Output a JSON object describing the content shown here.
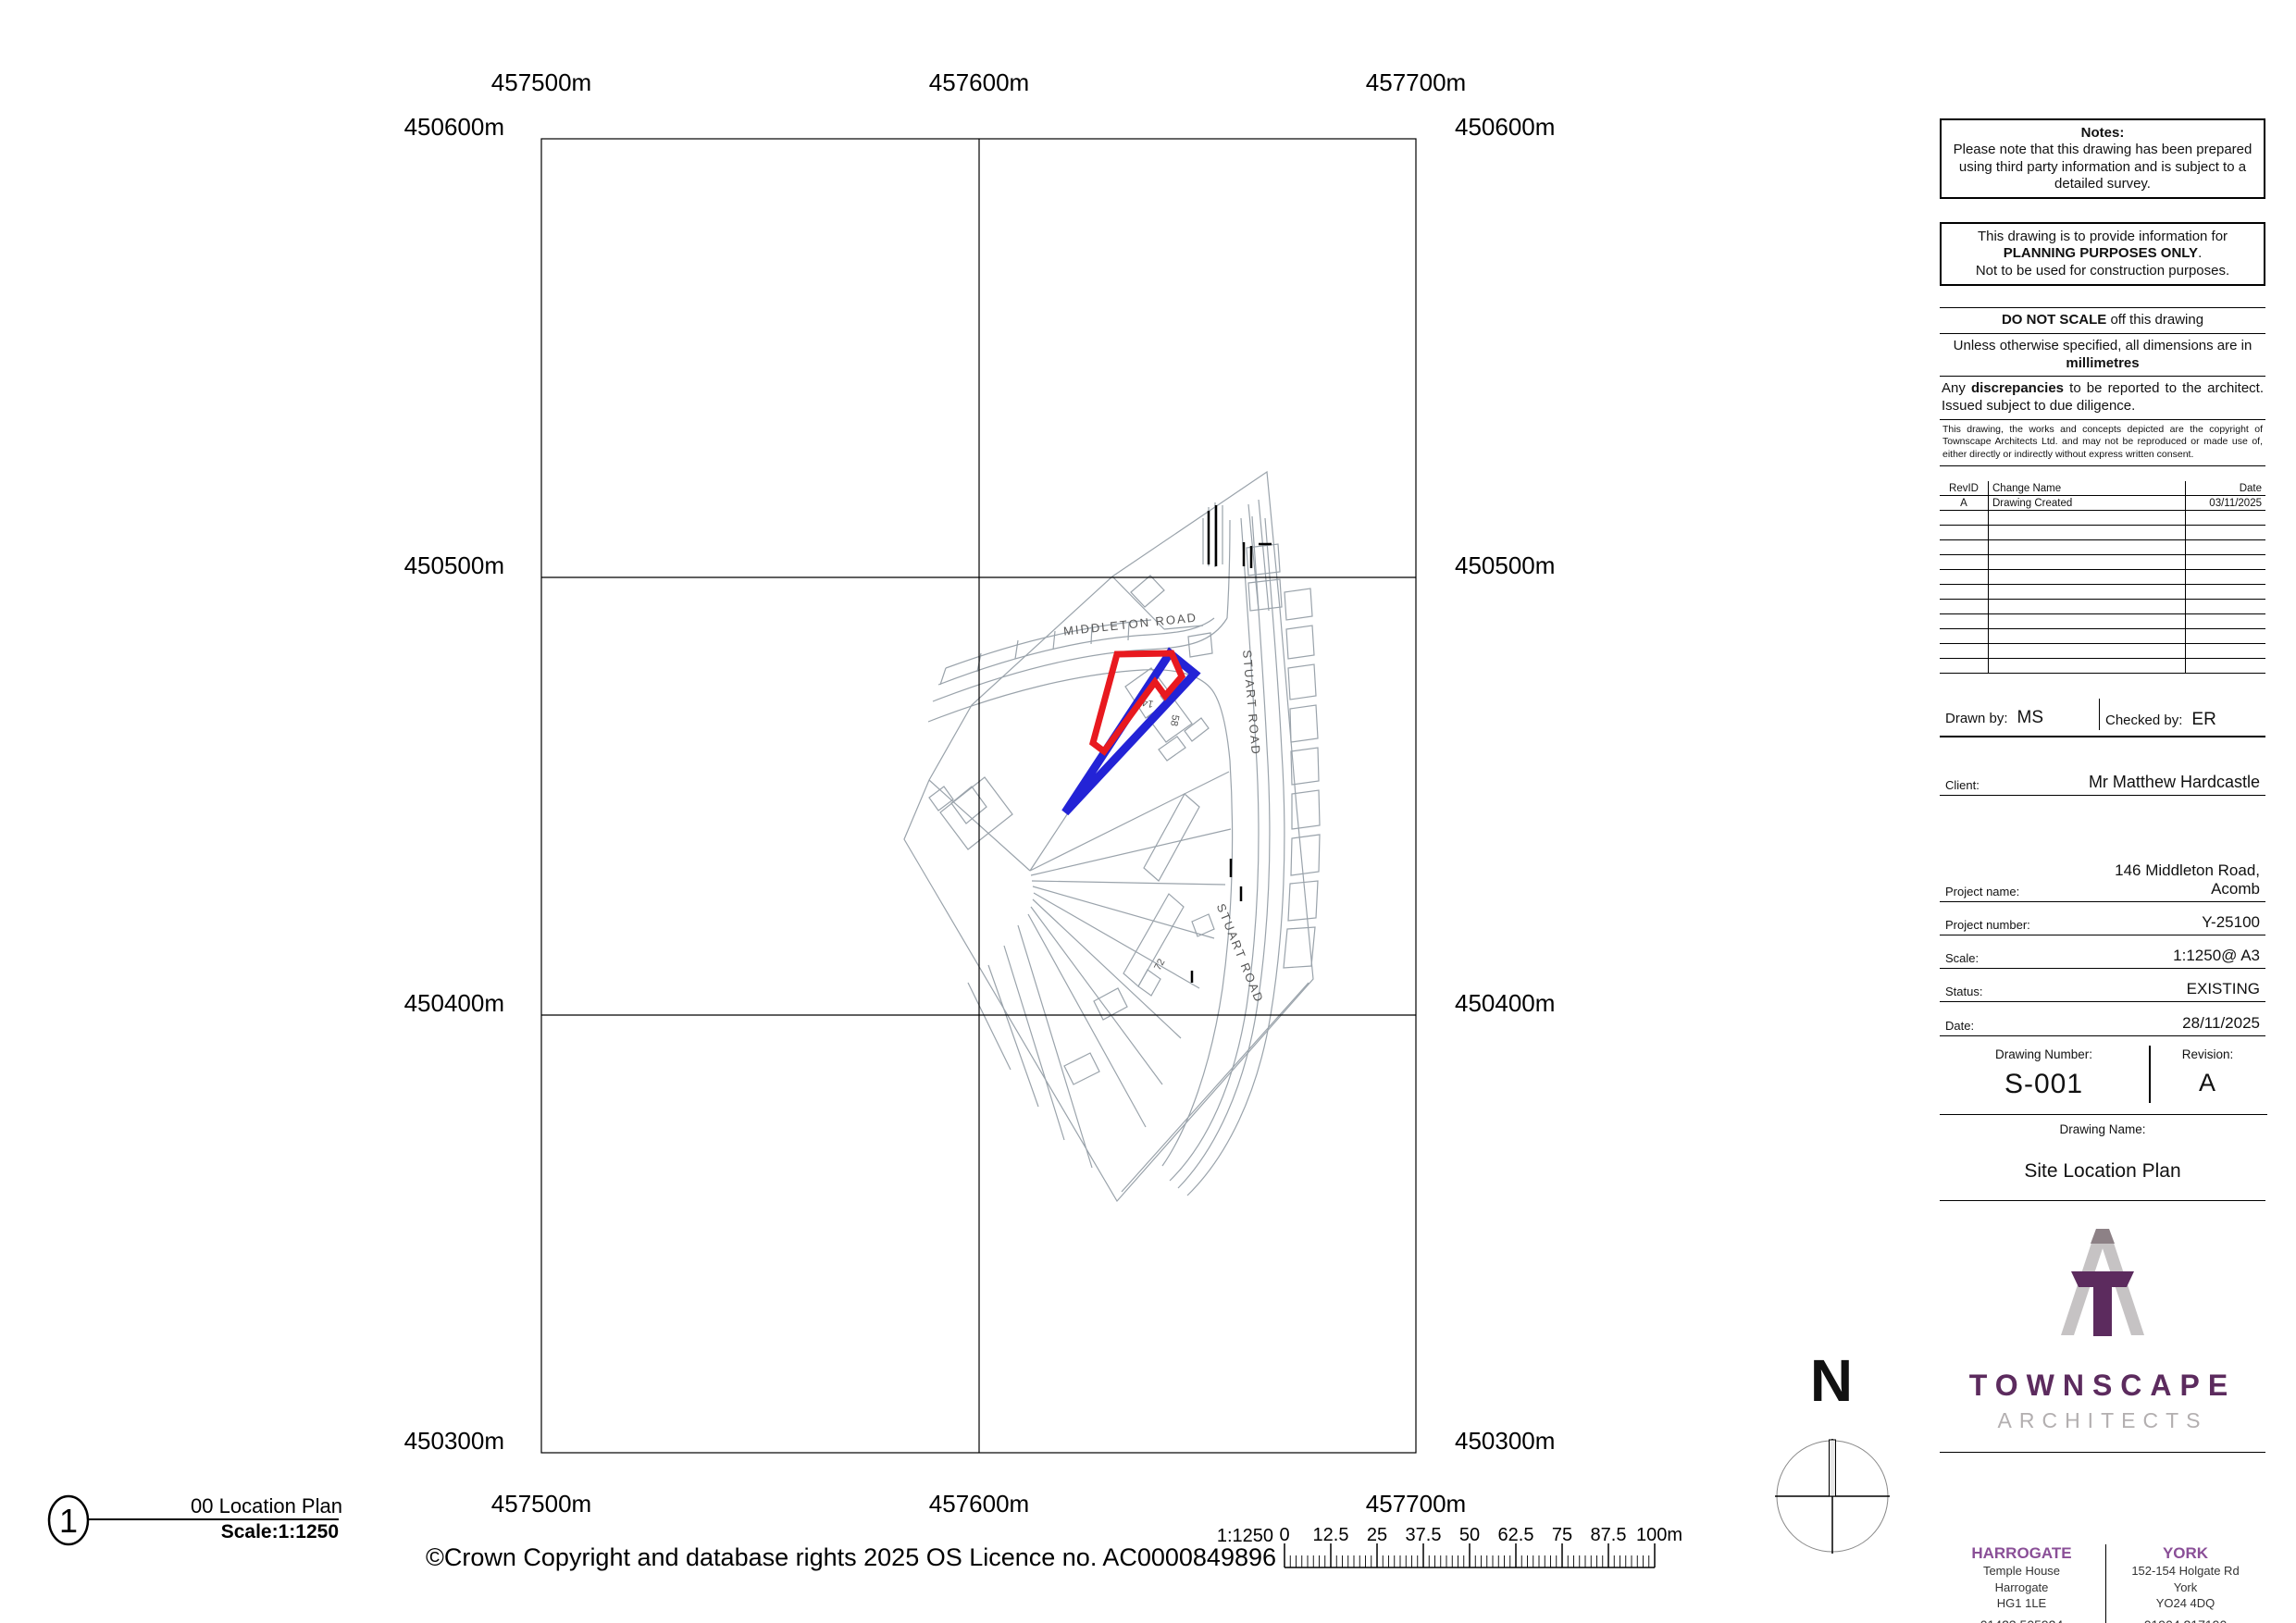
{
  "grid": {
    "eastings": [
      "457500m",
      "457600m",
      "457700m"
    ],
    "northings": [
      "450600m",
      "450500m",
      "450400m",
      "450300m"
    ]
  },
  "map": {
    "road_label_middleton": "MIDDLETON ROAD",
    "road_label_stuart_upper": "STUART ROAD",
    "road_label_stuart_lower": "STUART ROAD",
    "house_146": "146",
    "house_58": "58",
    "house_72": "72",
    "site_boundary_color": "#e8191f",
    "highlight_color": "#2323d6"
  },
  "viewport": {
    "number": "1",
    "title": "00 Location Plan",
    "scale_label": "Scale:1:1250"
  },
  "copyright": "©Crown Copyright and database rights 2025 OS Licence no. AC0000849896",
  "scale_bar": {
    "ratio": "1:1250",
    "tick_labels": [
      "0",
      "12.5",
      "25",
      "37.5",
      "50",
      "62.5",
      "75",
      "87.5",
      "100m"
    ]
  },
  "compass": {
    "north_label": "N"
  },
  "titleblock": {
    "notes": {
      "title": "Notes:",
      "body": "Please note that this drawing has been prepared using third party information and is subject to a detailed survey."
    },
    "planning": {
      "line1": "This drawing is to provide information for",
      "line2": "PLANNING PURPOSES ONLY",
      "line2_suffix": ".",
      "line3": "Not to be used for construction purposes."
    },
    "do_not_scale": {
      "bold": "DO NOT SCALE",
      "rest": " off this drawing"
    },
    "dimensions": {
      "pre": "Unless otherwise specified, all dimensions are in ",
      "bold": "millimetres"
    },
    "discrepancies": {
      "pre": "Any ",
      "bold": "discrepancies",
      "rest": " to be reported to the architect. Issued subject to due diligence."
    },
    "copyright_small": "This drawing, the works and concepts depicted are the copyright of Townscape Architects Ltd. and may not be reproduced or made use of, either directly or indirectly without express written consent.",
    "revisions": {
      "headers": [
        "RevID",
        "Change Name",
        "Date"
      ],
      "row": {
        "rev": "A",
        "name": "Drawing Created",
        "date": "03/11/2025"
      }
    },
    "drawn_by": {
      "label": "Drawn by:",
      "value": "MS"
    },
    "checked_by": {
      "label": "Checked by:",
      "value": "ER"
    },
    "client": {
      "label": "Client:",
      "value": "Mr Matthew Hardcastle"
    },
    "project_name": {
      "label": "Project name:",
      "value_line1": "146 Middleton Road,",
      "value_line2": "Acomb"
    },
    "project_number": {
      "label": "Project number:",
      "value": "Y-25100"
    },
    "scale": {
      "label": "Scale:",
      "value": "1:1250@ A3"
    },
    "status": {
      "label": "Status:",
      "value": "EXISTING"
    },
    "date": {
      "label": "Date:",
      "value": "28/11/2025"
    },
    "drawing_number": {
      "label": "Drawing Number:",
      "value": "S-001"
    },
    "revision": {
      "label": "Revision:",
      "value": "A"
    },
    "drawing_name": {
      "label": "Drawing Name:",
      "value": "Site Location Plan"
    },
    "brand": {
      "wordmark": "TOWNSCAPE",
      "wordmark_sub": "ARCHITECTS",
      "purple": "#5c2b5e",
      "light_purple": "#8a4f97",
      "gray": "#b3afb0"
    },
    "offices": [
      {
        "city": "HARROGATE",
        "lines": [
          "Temple House",
          "Harrogate",
          "HG1 1LE"
        ],
        "phone": "01423 505924"
      },
      {
        "city": "YORK",
        "lines": [
          "152-154 Holgate Rd",
          "York",
          "YO24 4DQ"
        ],
        "phone": "01904 217190"
      }
    ]
  }
}
